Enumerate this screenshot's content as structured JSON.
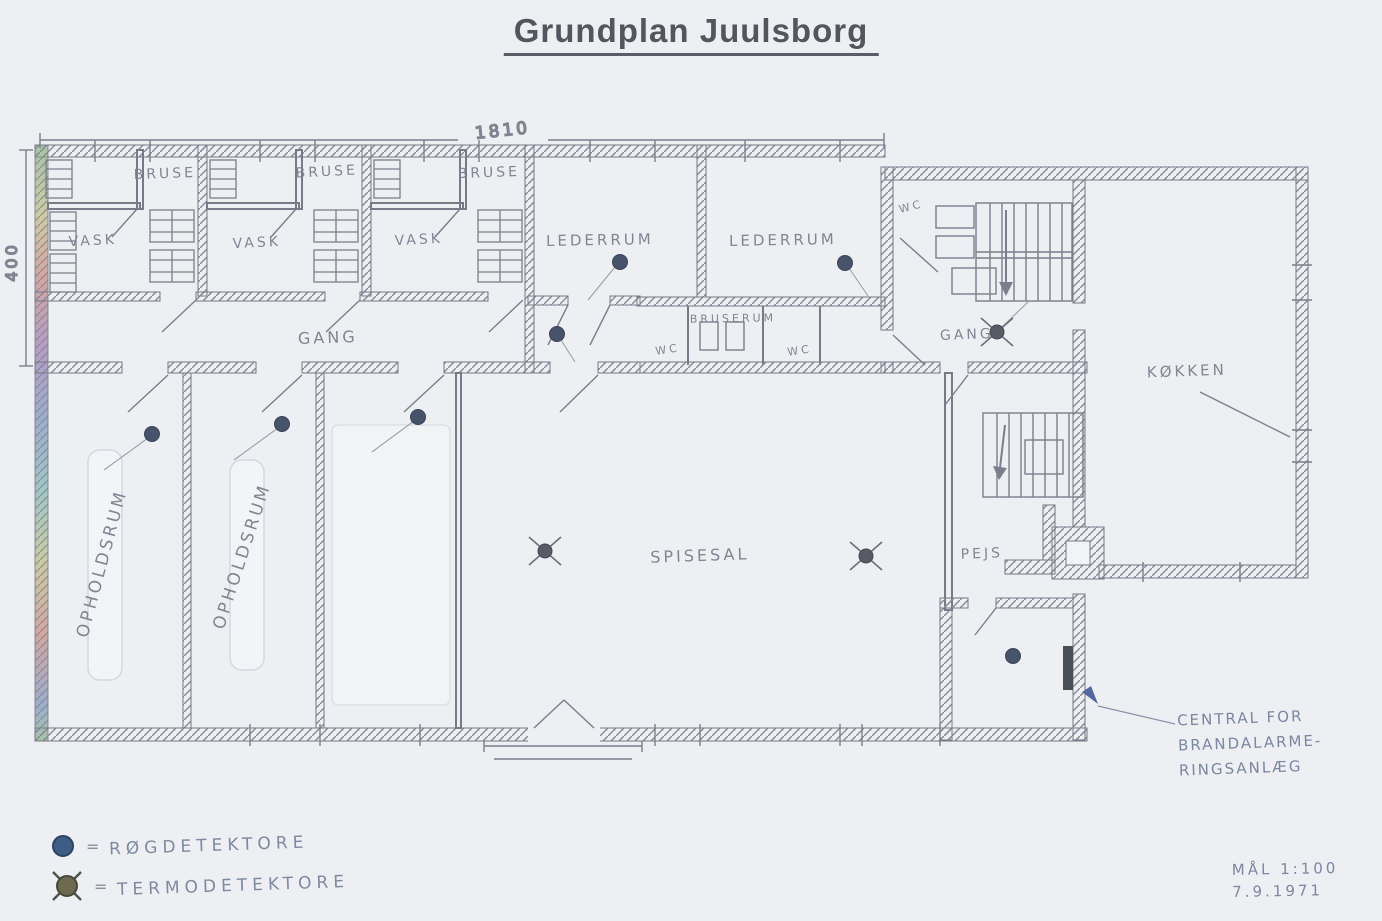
{
  "header": {
    "title": "Grundplan Juulsborg"
  },
  "dimensions": {
    "width": "1810",
    "height": "400"
  },
  "rooms": [
    {
      "id": "bruse-1",
      "label": "BRUSE",
      "x": 165,
      "y": 178,
      "size": 14,
      "rot": -2
    },
    {
      "id": "bruse-2",
      "label": "BRUSE",
      "x": 327,
      "y": 176,
      "size": 14,
      "rot": -3
    },
    {
      "id": "bruse-3",
      "label": "BRUSE",
      "x": 489,
      "y": 177,
      "size": 14,
      "rot": -2
    },
    {
      "id": "vask-1",
      "label": "VASK",
      "x": 93,
      "y": 245,
      "size": 14,
      "rot": -3
    },
    {
      "id": "vask-2",
      "label": "VASK",
      "x": 257,
      "y": 247,
      "size": 14,
      "rot": -3
    },
    {
      "id": "vask-3",
      "label": "VASK",
      "x": 419,
      "y": 244,
      "size": 14,
      "rot": -3
    },
    {
      "id": "gang-main",
      "label": "GANG",
      "x": 328,
      "y": 343,
      "size": 16,
      "rot": -2
    },
    {
      "id": "lederrum-1",
      "label": "LEDERRUM",
      "x": 600,
      "y": 245,
      "size": 15,
      "rot": -1
    },
    {
      "id": "lederrum-2",
      "label": "LEDERRUM",
      "x": 783,
      "y": 245,
      "size": 15,
      "rot": -1
    },
    {
      "id": "bruserum",
      "label": "BRUSERUM",
      "x": 733,
      "y": 322,
      "size": 11,
      "rot": -1
    },
    {
      "id": "wc-1",
      "label": "WC",
      "x": 668,
      "y": 353,
      "size": 11,
      "rot": -8
    },
    {
      "id": "wc-2",
      "label": "WC",
      "x": 800,
      "y": 354,
      "size": 11,
      "rot": -8
    },
    {
      "id": "wc-3",
      "label": "WC",
      "x": 912,
      "y": 210,
      "size": 11,
      "rot": -15
    },
    {
      "id": "gang-right",
      "label": "GANG",
      "x": 967,
      "y": 339,
      "size": 14,
      "rot": -2
    },
    {
      "id": "koekken",
      "label": "KØKKEN",
      "x": 1187,
      "y": 376,
      "size": 15,
      "rot": -2
    },
    {
      "id": "opholdsrum-1",
      "label": "OPHOLDSRUM",
      "x": 107,
      "y": 565,
      "size": 17,
      "rot": -75
    },
    {
      "id": "opholdsrum-2",
      "label": "OPHOLDSRUM",
      "x": 247,
      "y": 558,
      "size": 17,
      "rot": -72
    },
    {
      "id": "spisesal",
      "label": "SPISESAL",
      "x": 700,
      "y": 561,
      "size": 16,
      "rot": -2
    },
    {
      "id": "pejs",
      "label": "PEJS",
      "x": 982,
      "y": 558,
      "size": 14,
      "rot": -2
    }
  ],
  "detectors": {
    "smoke": [
      {
        "x": 152,
        "y": 434
      },
      {
        "x": 282,
        "y": 424
      },
      {
        "x": 418,
        "y": 417
      },
      {
        "x": 557,
        "y": 334
      },
      {
        "x": 620,
        "y": 262
      },
      {
        "x": 845,
        "y": 263
      },
      {
        "x": 1013,
        "y": 656
      }
    ],
    "thermo": [
      {
        "x": 545,
        "y": 551
      },
      {
        "x": 866,
        "y": 556
      },
      {
        "x": 997,
        "y": 332
      }
    ]
  },
  "legend": {
    "eq": "=",
    "items": [
      {
        "id": "smoke",
        "label": "RØGDETEKTORE"
      },
      {
        "id": "thermo",
        "label": "TERMODETEKTORE"
      }
    ]
  },
  "annotation": {
    "lines": [
      "CENTRAL FOR",
      "BRANDALARME-",
      "RINGSANLÆG"
    ]
  },
  "title_block": {
    "scale": "MÅL 1:100",
    "date": "7.9.1971"
  },
  "colors": {
    "paper": "#edeff2",
    "pencil": "#7a7f8b",
    "handwriting": "#7c818f",
    "blue_pencil": "#7b86a2",
    "smoke_detector": "#46536a",
    "thermo_detector": "#565b66",
    "alarm_panel": "#4a4f58"
  }
}
